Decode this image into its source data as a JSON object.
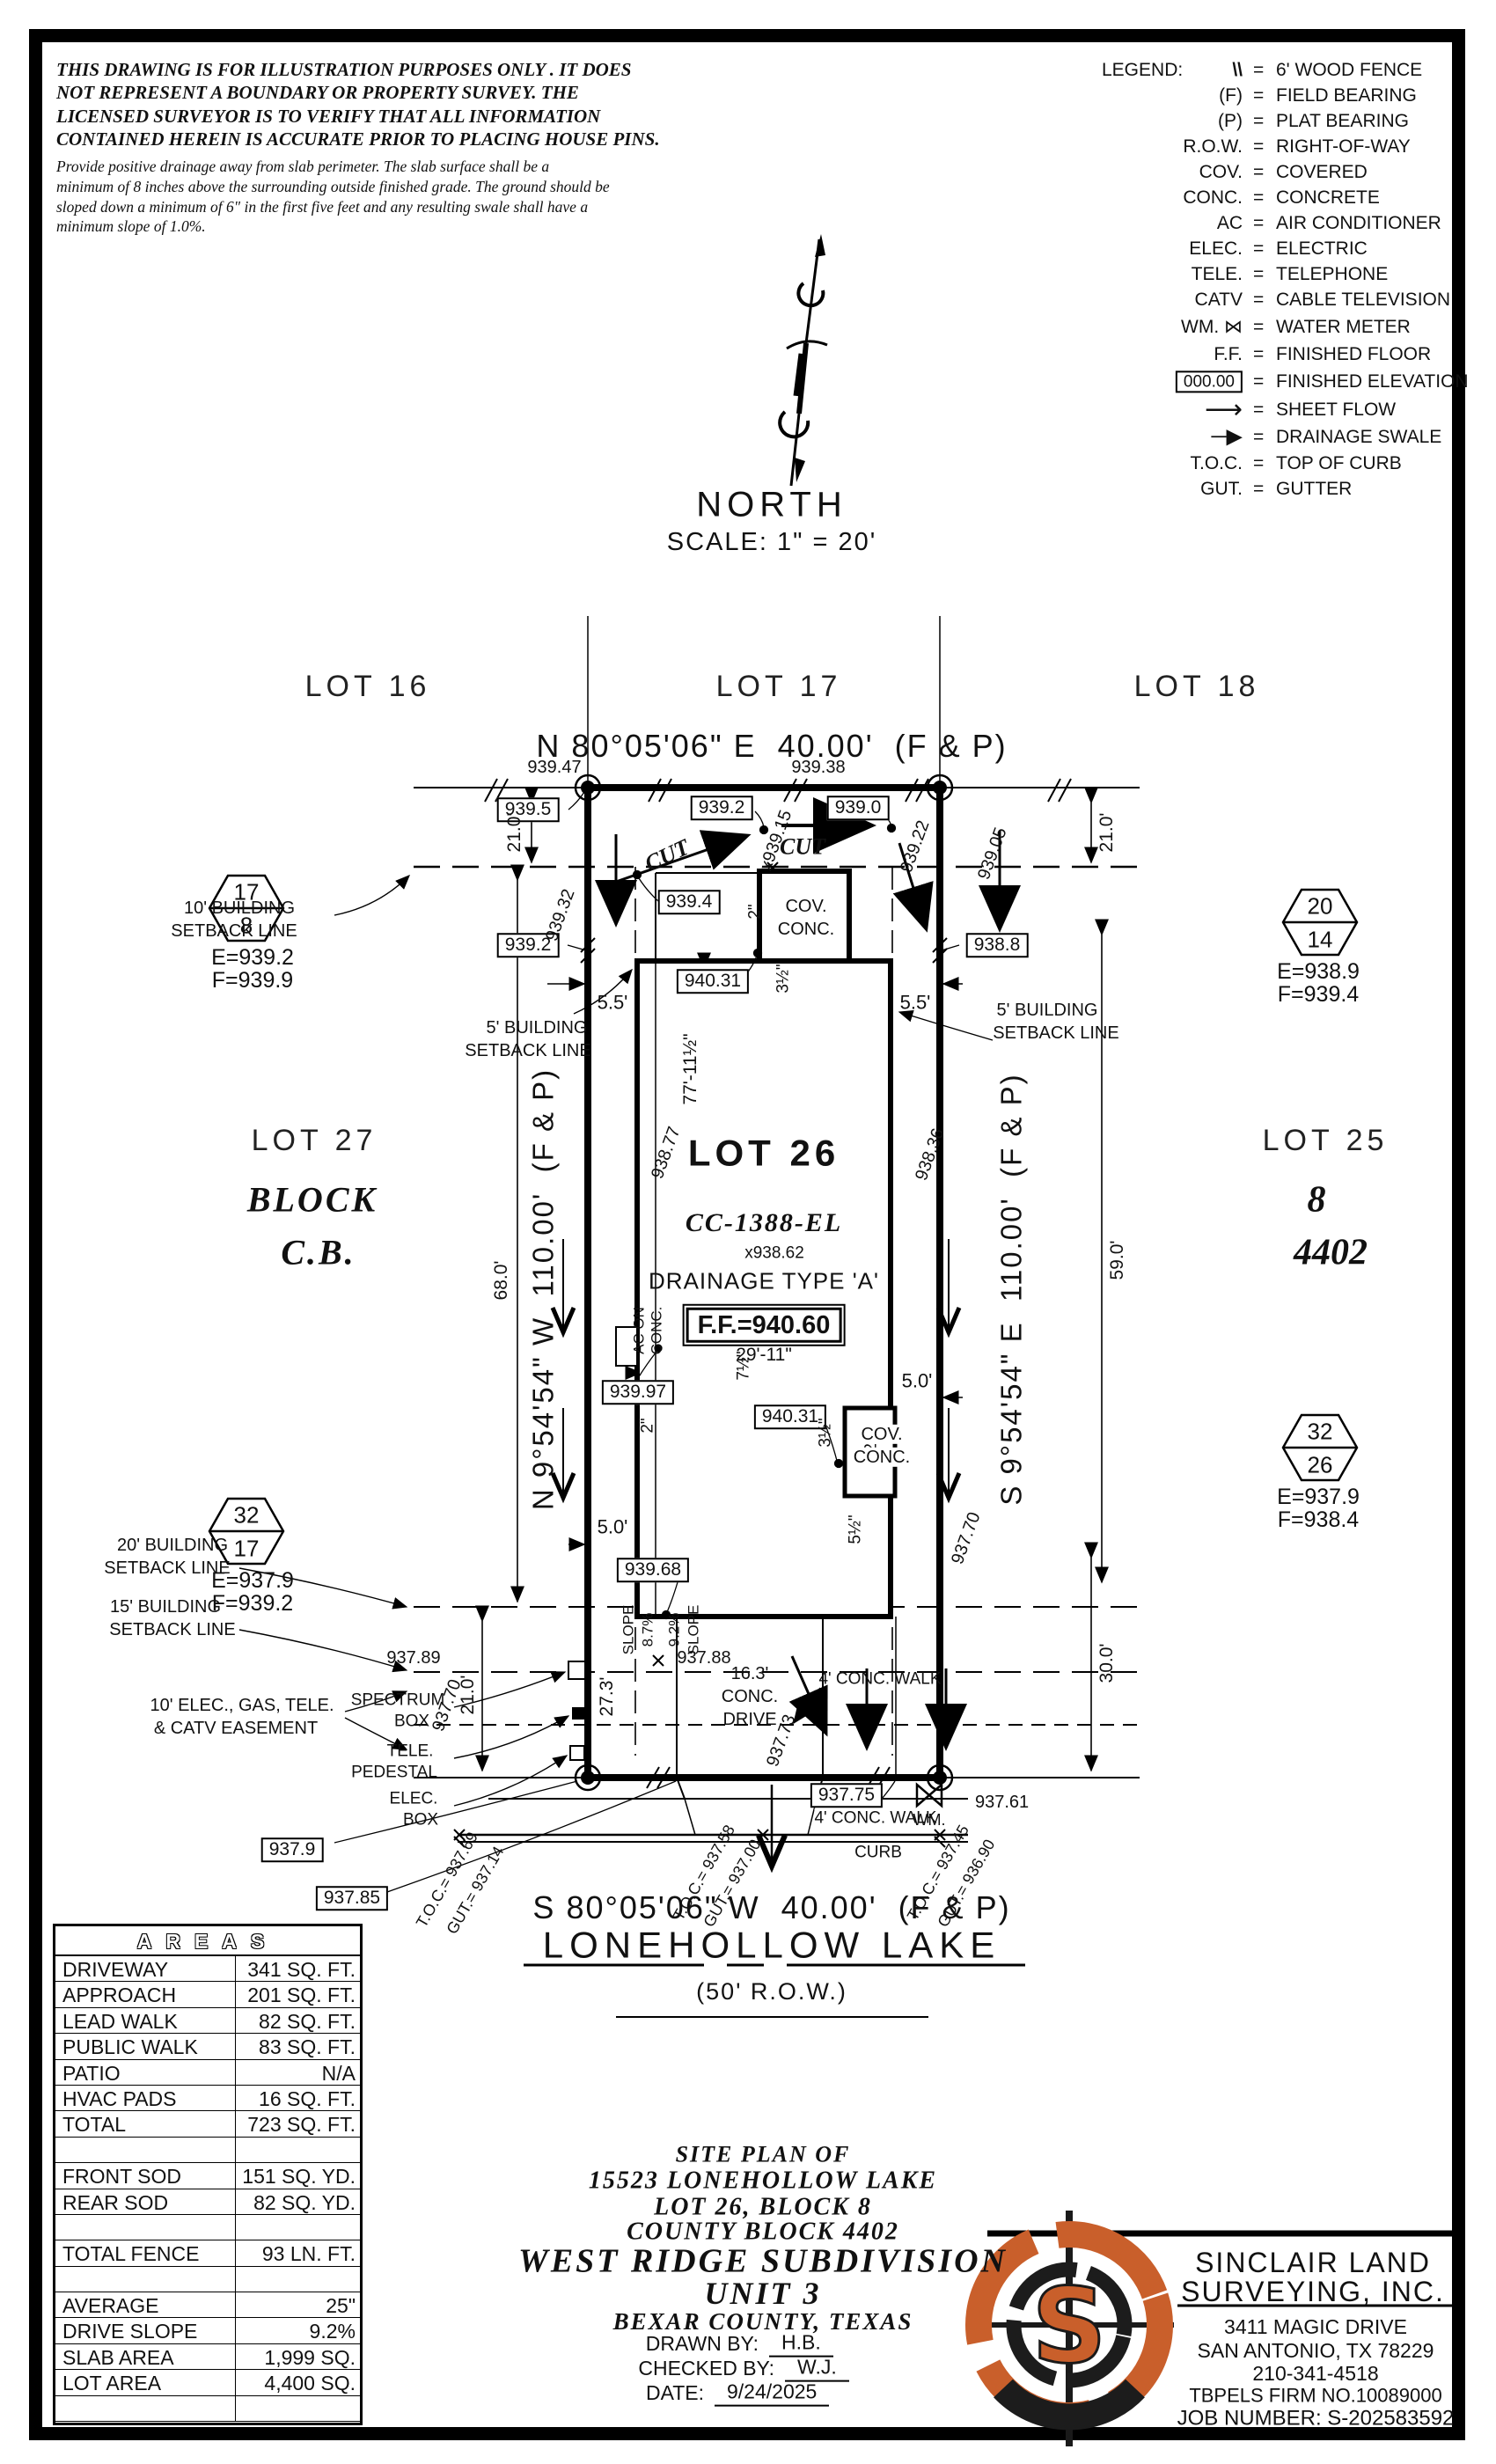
{
  "disclaimer": {
    "para1": "THIS DRAWING IS FOR ILLUSTRATION PURPOSES ONLY . IT DOES\nNOT REPRESENT A BOUNDARY OR PROPERTY SURVEY. THE\nLICENSED SURVEYOR IS TO VERIFY THAT ALL INFORMATION\nCONTAINED HEREIN IS ACCURATE PRIOR TO PLACING HOUSE PINS.",
    "para2": "Provide positive drainage away from slab perimeter. The slab surface shall be a\nminimum of 8 inches above the surrounding outside finished grade. The ground should be\nsloped down a minimum of 6\" in the first five feet and any resulting swale shall have a\nminimum slope of 1.0%."
  },
  "legend": {
    "title": "LEGEND:",
    "eq": "=",
    "items": [
      {
        "sym": "\\\\",
        "label": "6' WOOD FENCE"
      },
      {
        "sym": "(F)",
        "label": "FIELD BEARING"
      },
      {
        "sym": "(P)",
        "label": "PLAT BEARING"
      },
      {
        "sym": "R.O.W.",
        "label": "RIGHT-OF-WAY"
      },
      {
        "sym": "COV.",
        "label": "COVERED"
      },
      {
        "sym": "CONC.",
        "label": "CONCRETE"
      },
      {
        "sym": "AC",
        "label": "AIR CONDITIONER"
      },
      {
        "sym": "ELEC.",
        "label": "ELECTRIC"
      },
      {
        "sym": "TELE.",
        "label": "TELEPHONE"
      },
      {
        "sym": "CATV",
        "label": "CABLE TELEVISION"
      },
      {
        "sym": "WM. ⋈",
        "label": "WATER METER"
      },
      {
        "sym": "F.F.",
        "label": "FINISHED FLOOR"
      },
      {
        "sym": "000.00",
        "label": "FINISHED ELEVATION"
      },
      {
        "sym": "⟶",
        "label": "SHEET FLOW"
      },
      {
        "sym": "─▶",
        "label": "DRAINAGE SWALE"
      },
      {
        "sym": "T.O.C.",
        "label": "TOP OF CURB"
      },
      {
        "sym": "GUT.",
        "label": "GUTTER"
      }
    ]
  },
  "north": {
    "label": "NORTH",
    "scale": "SCALE: 1\" = 20'"
  },
  "lots": {
    "lot16": "LOT 16",
    "lot17": "LOT 17",
    "lot18": "LOT 18",
    "lot26": "LOT 26",
    "lot27": "LOT 27",
    "block_word": "BLOCK",
    "cb": "C.B.",
    "lot25": "LOT 25",
    "lot25_block": "8",
    "lot25_cb": "4402"
  },
  "bearings": {
    "top": "N 80°05'06\" E  40.00'  (F & P)",
    "bottom": "S 80°05'06\" W  40.00'  (F & P)",
    "left": "N 9°54'54\" W  110.00'  (F & P)",
    "right": "S 9°54'54\" E  110.00'  (F & P)"
  },
  "street": {
    "name": "LONEHOLLOW LAKE",
    "row": "(50' R.O.W.)"
  },
  "house": {
    "cc": "CC-1388-EL",
    "spot": "x938.62",
    "drainage": "DRAINAGE TYPE 'A'",
    "ff": "F.F.=940.60"
  },
  "markers": {
    "m1": {
      "top": "17",
      "bottom": "8",
      "e": "E=939.2",
      "f": "F=939.9"
    },
    "m2": {
      "top": "20",
      "bottom": "14",
      "e": "E=938.9",
      "f": "F=939.4"
    },
    "m3": {
      "top": "32",
      "bottom": "26",
      "e": "E=937.9",
      "f": "F=938.4"
    },
    "m4": {
      "top": "32",
      "bottom": "17",
      "e": "E=937.9",
      "f": "F=939.2"
    }
  },
  "plan": {
    "cut": "CUT",
    "elev": {
      "b939_5": "939.5",
      "b939_2": "939.2",
      "b939_0": "939.0",
      "b939_4": "939.4",
      "b938_8": "938.8",
      "b940_31": "940.31",
      "b939_97": "939.97",
      "b939_68": "939.68",
      "b937_9": "937.9",
      "b937_85": "937.85",
      "b937_75": "937.75",
      "p939_47": "939.47",
      "p939_38": "939.38",
      "p937_89": "937.89",
      "p937_88": "937.88",
      "p937_61": "937.61",
      "d939_32": "939.32",
      "d939_22": "939.22",
      "d939_05": "939.05",
      "d939_15": "x939.15",
      "d938_77": "938.77",
      "d938_36": "938.36",
      "d937_70": "937.70",
      "d937_73": "937.73"
    },
    "dims": {
      "w21": "21.0'",
      "w68": "68.0'",
      "w59": "59.0'",
      "w30": "30.0'",
      "h77": "77'-11½\"",
      "w29": "29'-11\"",
      "d27": "27.3'",
      "s55": "5.5'",
      "s50": "5.0'",
      "in2": "2\"",
      "in35": "3½\"",
      "in55": "5½\"",
      "in75": "7½\""
    },
    "setbacks": {
      "b10a": "10' BUILDING",
      "b5a": "5' BUILDING",
      "b20a": "20' BUILDING",
      "b15a": "15' BUILDING",
      "sbline": "SETBACK LINE",
      "easea": "10' ELEC., GAS, TELE.",
      "easeb": "& CATV EASEMENT"
    },
    "features": {
      "ac1": "AC ON",
      "ac2": "CONC.",
      "cov1": "COV.",
      "cov2": "CONC.",
      "walk4": "4' CONC. WALK",
      "curb": "CURB",
      "wm": "WM.",
      "spec1": "SPECTRUM",
      "spec2": "BOX",
      "tele1": "TELE.",
      "tele2": "PEDESTAL",
      "elec1": "ELEC.",
      "elec2": "BOX",
      "drive1": "16.3'",
      "drive2": "CONC.",
      "drive3": "DRIVE",
      "slope": "SLOPE",
      "s87": "8.7%",
      "s92": "9.2%"
    },
    "toc": {
      "t1a": "T.O.C.= 937.69",
      "t1b": "GUT.= 937.14",
      "t2a": "T.O.C.= 937.58",
      "t2b": "GUT.= 937.00",
      "t3a": "T.O.C.= 937.45",
      "t3b": "GUT.= 936.90"
    }
  },
  "areas": {
    "title": "AREAS",
    "rows": [
      {
        "label": "DRIVEWAY",
        "value": "341 SQ. FT."
      },
      {
        "label": "APPROACH",
        "value": "201 SQ. FT."
      },
      {
        "label": "LEAD WALK",
        "value": "82 SQ. FT."
      },
      {
        "label": "PUBLIC WALK",
        "value": "83 SQ. FT."
      },
      {
        "label": "PATIO",
        "value": "N/A"
      },
      {
        "label": "HVAC PADS",
        "value": "16 SQ. FT."
      },
      {
        "label": "TOTAL",
        "value": "723 SQ. FT."
      },
      {
        "label": "",
        "value": ""
      },
      {
        "label": "FRONT SOD",
        "value": "151 SQ. YD."
      },
      {
        "label": "REAR SOD",
        "value": "82 SQ. YD."
      },
      {
        "label": "",
        "value": ""
      },
      {
        "label": "TOTAL FENCE",
        "value": "93 LN. FT."
      },
      {
        "label": "",
        "value": ""
      },
      {
        "label": "AVERAGE EXPOSURE",
        "value": "25\""
      },
      {
        "label": "DRIVE SLOPE",
        "value": "9.2%"
      },
      {
        "label": "SLAB AREA",
        "value": "1,999 SQ. FT."
      },
      {
        "label": "LOT AREA",
        "value": "4,400 SQ. FT."
      },
      {
        "label": "",
        "value": ""
      }
    ]
  },
  "title_block": {
    "l1": "SITE PLAN OF",
    "l2": "15523 LONEHOLLOW LAKE",
    "l3": "LOT 26, BLOCK 8",
    "l4": "COUNTY BLOCK 4402",
    "l5": "WEST RIDGE SUBDIVISION",
    "l6": "UNIT 3",
    "l7": "BEXAR COUNTY, TEXAS",
    "drawn_label": "DRAWN BY:",
    "drawn": "H.B.",
    "checked_label": "CHECKED BY:",
    "checked": "W.J.",
    "date_label": "DATE:",
    "date": "9/24/2025"
  },
  "surveyor": {
    "logo_letter": "S",
    "name1": "SINCLAIR LAND",
    "name2": "SURVEYING, INC.",
    "addr1": "3411 MAGIC DRIVE",
    "addr2": "SAN ANTONIO, TX 78229",
    "phone": "210-341-4518",
    "firm": "TBPELS FIRM NO.10089000",
    "job": "JOB NUMBER: S-202583592",
    "accent": "#C95F2B"
  }
}
